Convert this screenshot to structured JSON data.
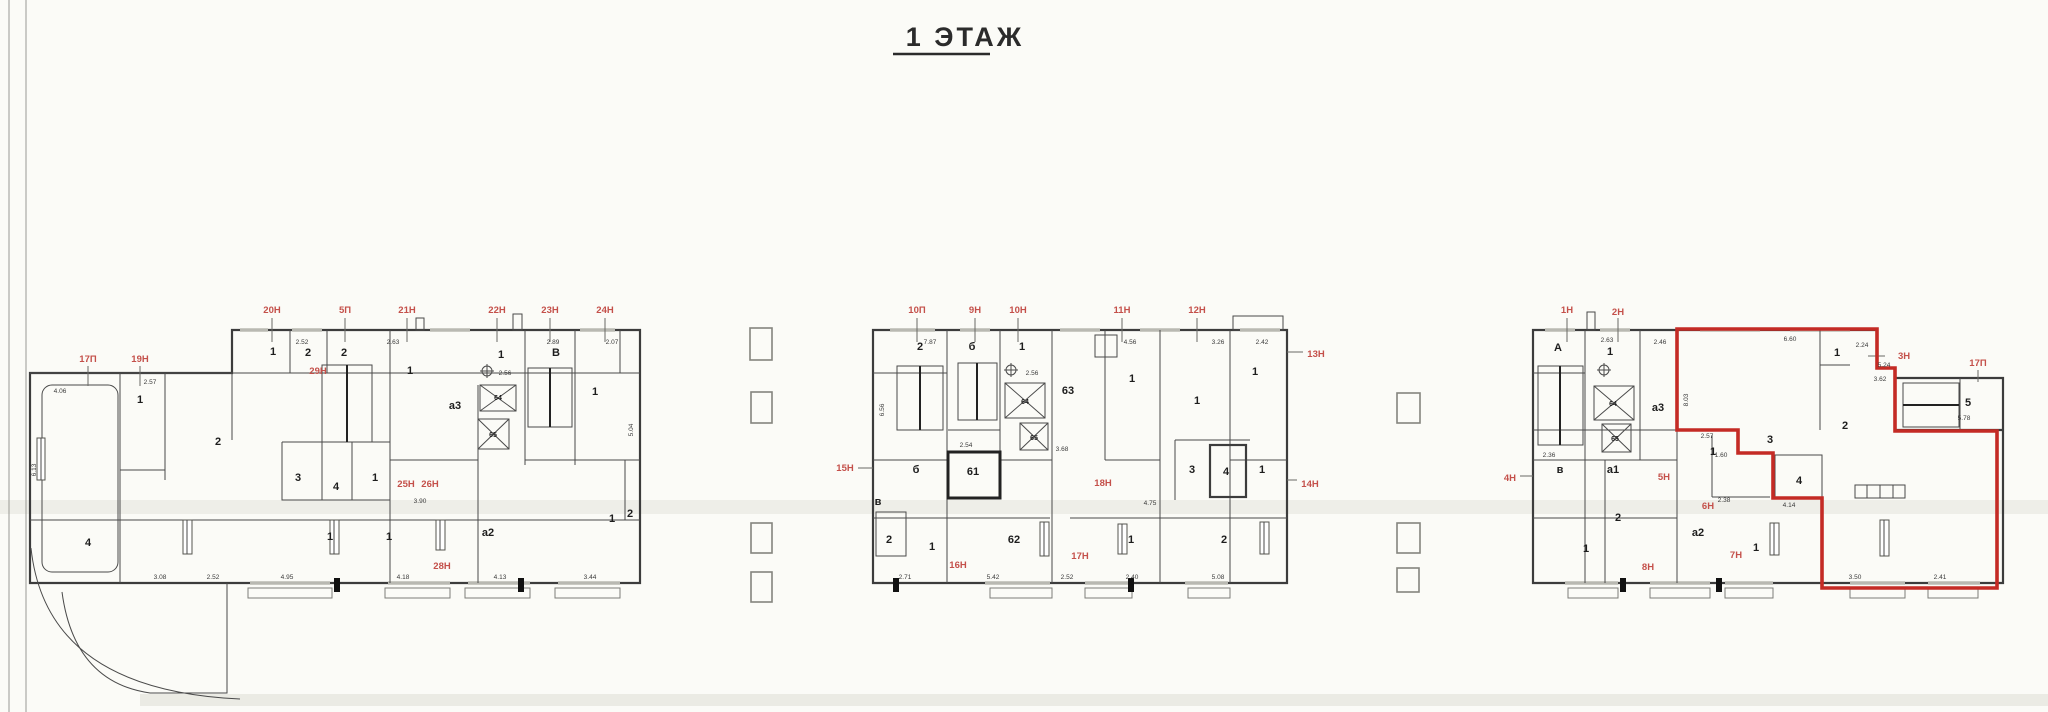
{
  "title": {
    "text": "1 ЭТАЖ"
  },
  "colors": {
    "highlight_red": "#c42b25",
    "label_red": "#c4504a"
  },
  "sections": {
    "left": {
      "top_labels": [
        "20Н",
        "5П",
        "21Н",
        "22Н",
        "23Н",
        "24Н"
      ],
      "side_labels": [
        "17П",
        "19Н"
      ],
      "inner_labels": [
        "29Н",
        "25Н",
        "26Н",
        "28Н"
      ],
      "rooms": [
        "4",
        "1",
        "2",
        "1",
        "2",
        "2",
        "1",
        "1",
        "В",
        "1",
        "а3",
        "64",
        "65",
        "3",
        "4",
        "1",
        "1",
        "1",
        "а2",
        "1",
        "2"
      ],
      "dims": [
        "2.52",
        "2.63",
        "2.89",
        "2.07",
        "4.06",
        "2.57",
        "3.08",
        "2.52",
        "4.95",
        "4.18",
        "4.13",
        "3.44",
        "6.13",
        "5.04",
        "3.90",
        "2.56"
      ]
    },
    "middle": {
      "top_labels": [
        "10П",
        "9Н",
        "10Н",
        "11Н",
        "12Н"
      ],
      "side_labels": [
        "13Н",
        "15Н",
        "14Н"
      ],
      "inner_labels": [
        "16Н",
        "17Н",
        "18Н"
      ],
      "rooms": [
        "2",
        "б",
        "1",
        "64",
        "65",
        "63",
        "1",
        "1",
        "1",
        "в",
        "б",
        "61",
        "2",
        "1",
        "62",
        "1",
        "3",
        "4",
        "1",
        "2"
      ],
      "dims": [
        "7.87",
        "4.56",
        "3.26",
        "2.42",
        "2.56",
        "3.68",
        "2.54",
        "5.42",
        "2.52",
        "2.40",
        "5.08",
        "2.71",
        "6.56",
        "4.75"
      ]
    },
    "right": {
      "top_labels": [
        "1Н",
        "2Н"
      ],
      "side_labels": [
        "3Н",
        "17П",
        "4Н"
      ],
      "inner_labels": [
        "5Н",
        "6Н",
        "7Н",
        "8Н"
      ],
      "rooms": [
        "А",
        "1",
        "а3",
        "64",
        "65",
        "1",
        "2",
        "3",
        "1",
        "4",
        "5",
        "в",
        "а1",
        "2",
        "1",
        "а2",
        "1"
      ],
      "dims": [
        "2.63",
        "2.46",
        "6.60",
        "2.24",
        "5.24",
        "3.62",
        "5.78",
        "2.57",
        "1.60",
        "2.38",
        "4.14",
        "3.50",
        "2.41",
        "2.36",
        "8.03"
      ]
    }
  }
}
